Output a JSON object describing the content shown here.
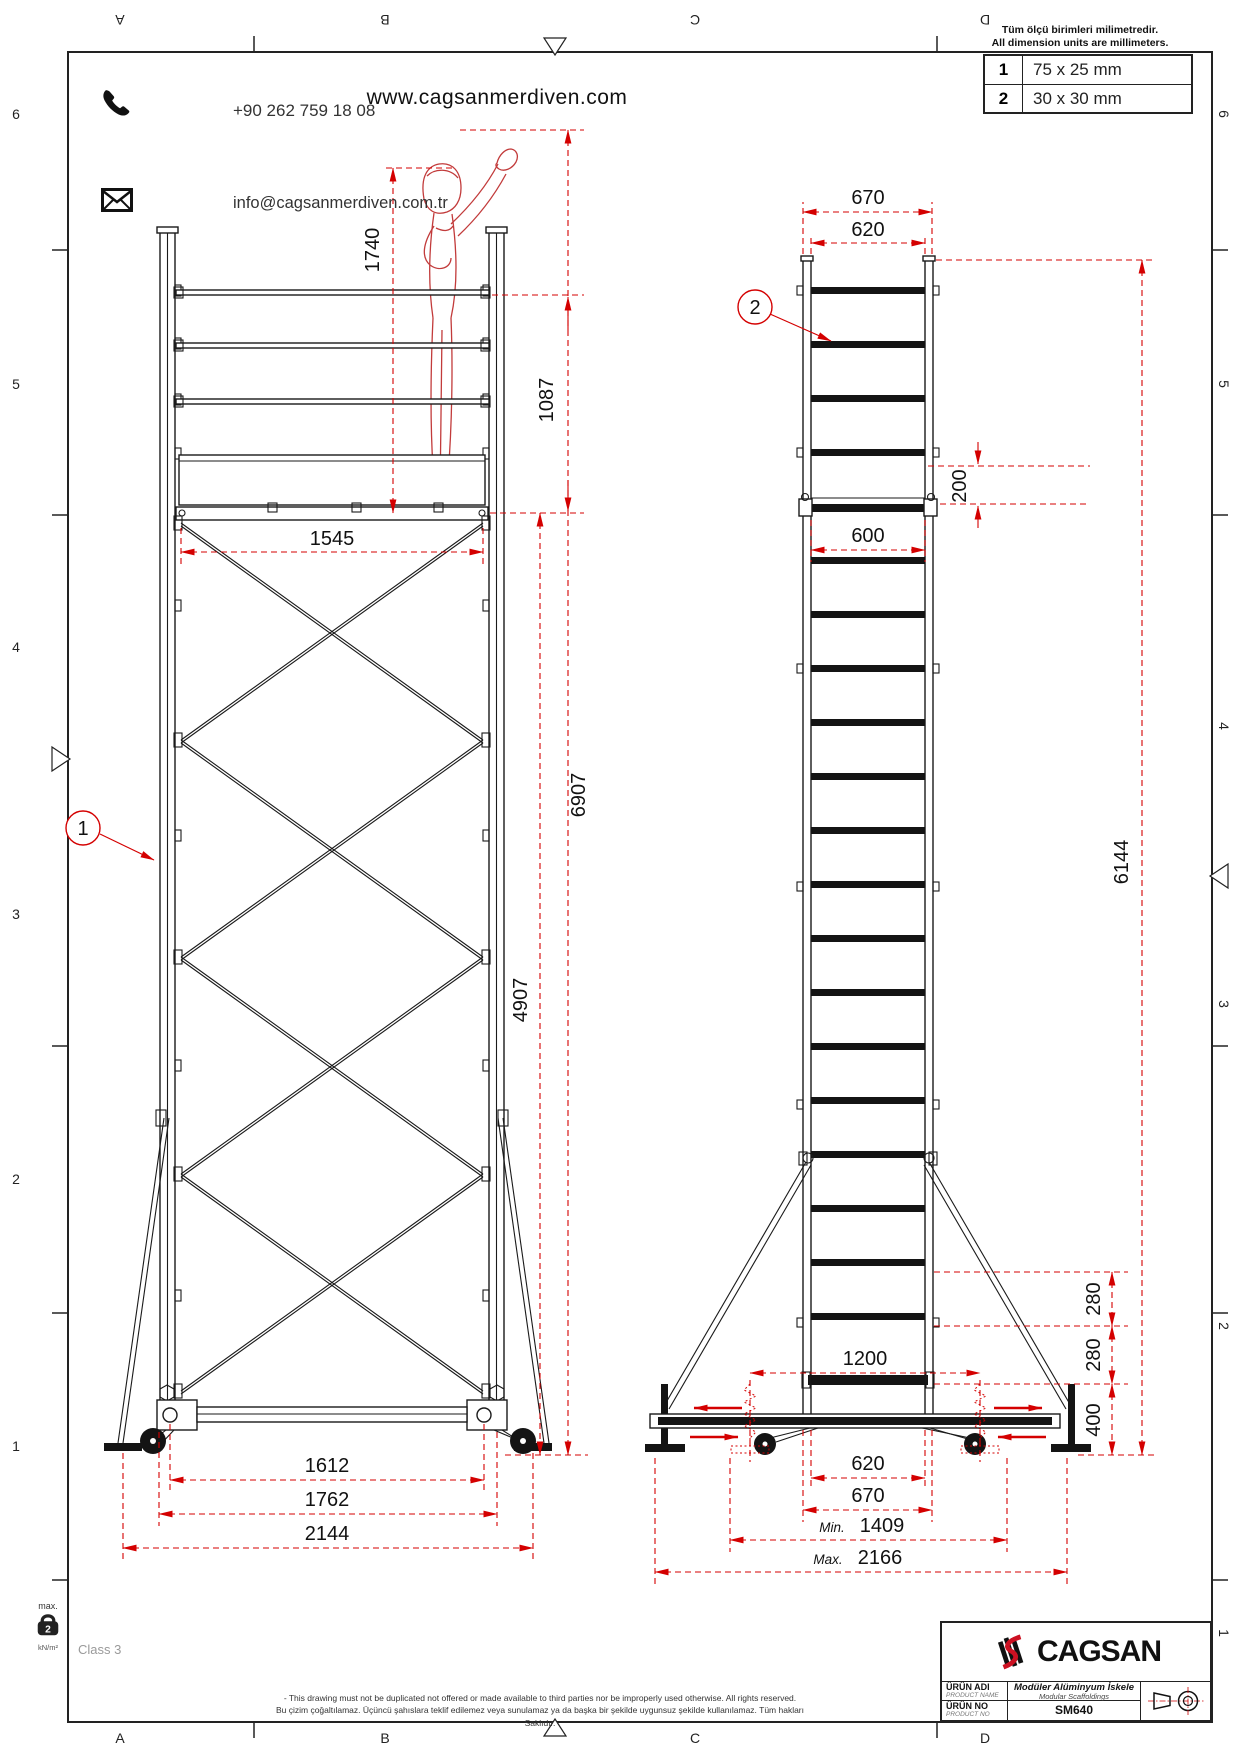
{
  "header": {
    "phone": "+90 262 759 18 08",
    "email": "info@cagsanmerdiven.com.tr",
    "website": "www.cagsanmerdiven.com",
    "units_note_line1": "Tüm ölçü birimleri milimetredir.",
    "units_note_line2": "All dimension units are millimeters.",
    "profile_table": {
      "rows": [
        {
          "item": "1",
          "size": "75 x 25 mm"
        },
        {
          "item": "2",
          "size": "30 x 30 mm"
        }
      ]
    }
  },
  "sheet_grid": {
    "top_letters": [
      "A",
      "B",
      "C",
      "D"
    ],
    "bottom_letters": [
      "A",
      "B",
      "C",
      "D"
    ],
    "left_numbers": [
      "6",
      "5",
      "4",
      "3",
      "2",
      "1"
    ],
    "right_numbers": [
      "6",
      "5",
      "4",
      "3",
      "2",
      "1"
    ]
  },
  "watermark": "CAGSAN",
  "callouts": {
    "c1": "1",
    "c2": "2"
  },
  "dims": {
    "front": {
      "person_height": "1740",
      "guardrail_height": "1087",
      "brace_width": "1545",
      "working_height": "6907",
      "platform_height": "4907",
      "wheel_track": "1612",
      "frame_track": "1762",
      "outrigger_track": "2144"
    },
    "side": {
      "top_outer": "670",
      "top_inner": "620",
      "platform_drop": "200",
      "platform_width": "600",
      "frame_height": "6144",
      "jack_span": "1200",
      "step_a": "280",
      "step_b": "280",
      "base_height": "400",
      "bottom_inner": "620",
      "bottom_outer": "670",
      "min_label": "Min.",
      "min_value": "1409",
      "max_label": "Max.",
      "max_value": "2166"
    }
  },
  "title_block": {
    "brand": "CAGSAN",
    "product_name_label_tr": "ÜRÜN ADI",
    "product_name_label_en": "PRODUCT NAME",
    "product_name_tr": "Modüler Alüminyum İskele",
    "product_name_en": "Modular Scaffoldings",
    "product_no_label_tr": "ÜRÜN NO",
    "product_no_label_en": "PRODUCT NO",
    "product_no": "SM640"
  },
  "footer": {
    "max_label": "max.",
    "load_value": "2",
    "load_unit": "kN/m²",
    "class_text": "Class 3",
    "disclaimer_line1": "- This drawing must not be duplicated not offered or made available to third parties nor be improperly used otherwise. All rights reserved.",
    "disclaimer_line2": "Bu çizim çoğaltılamaz. Üçüncü şahıslara teklif edilemez veya sunulamaz ya da başka bir şekilde uygunsuz şekilde kullanılamaz. Tüm hakları Saklıdır."
  }
}
